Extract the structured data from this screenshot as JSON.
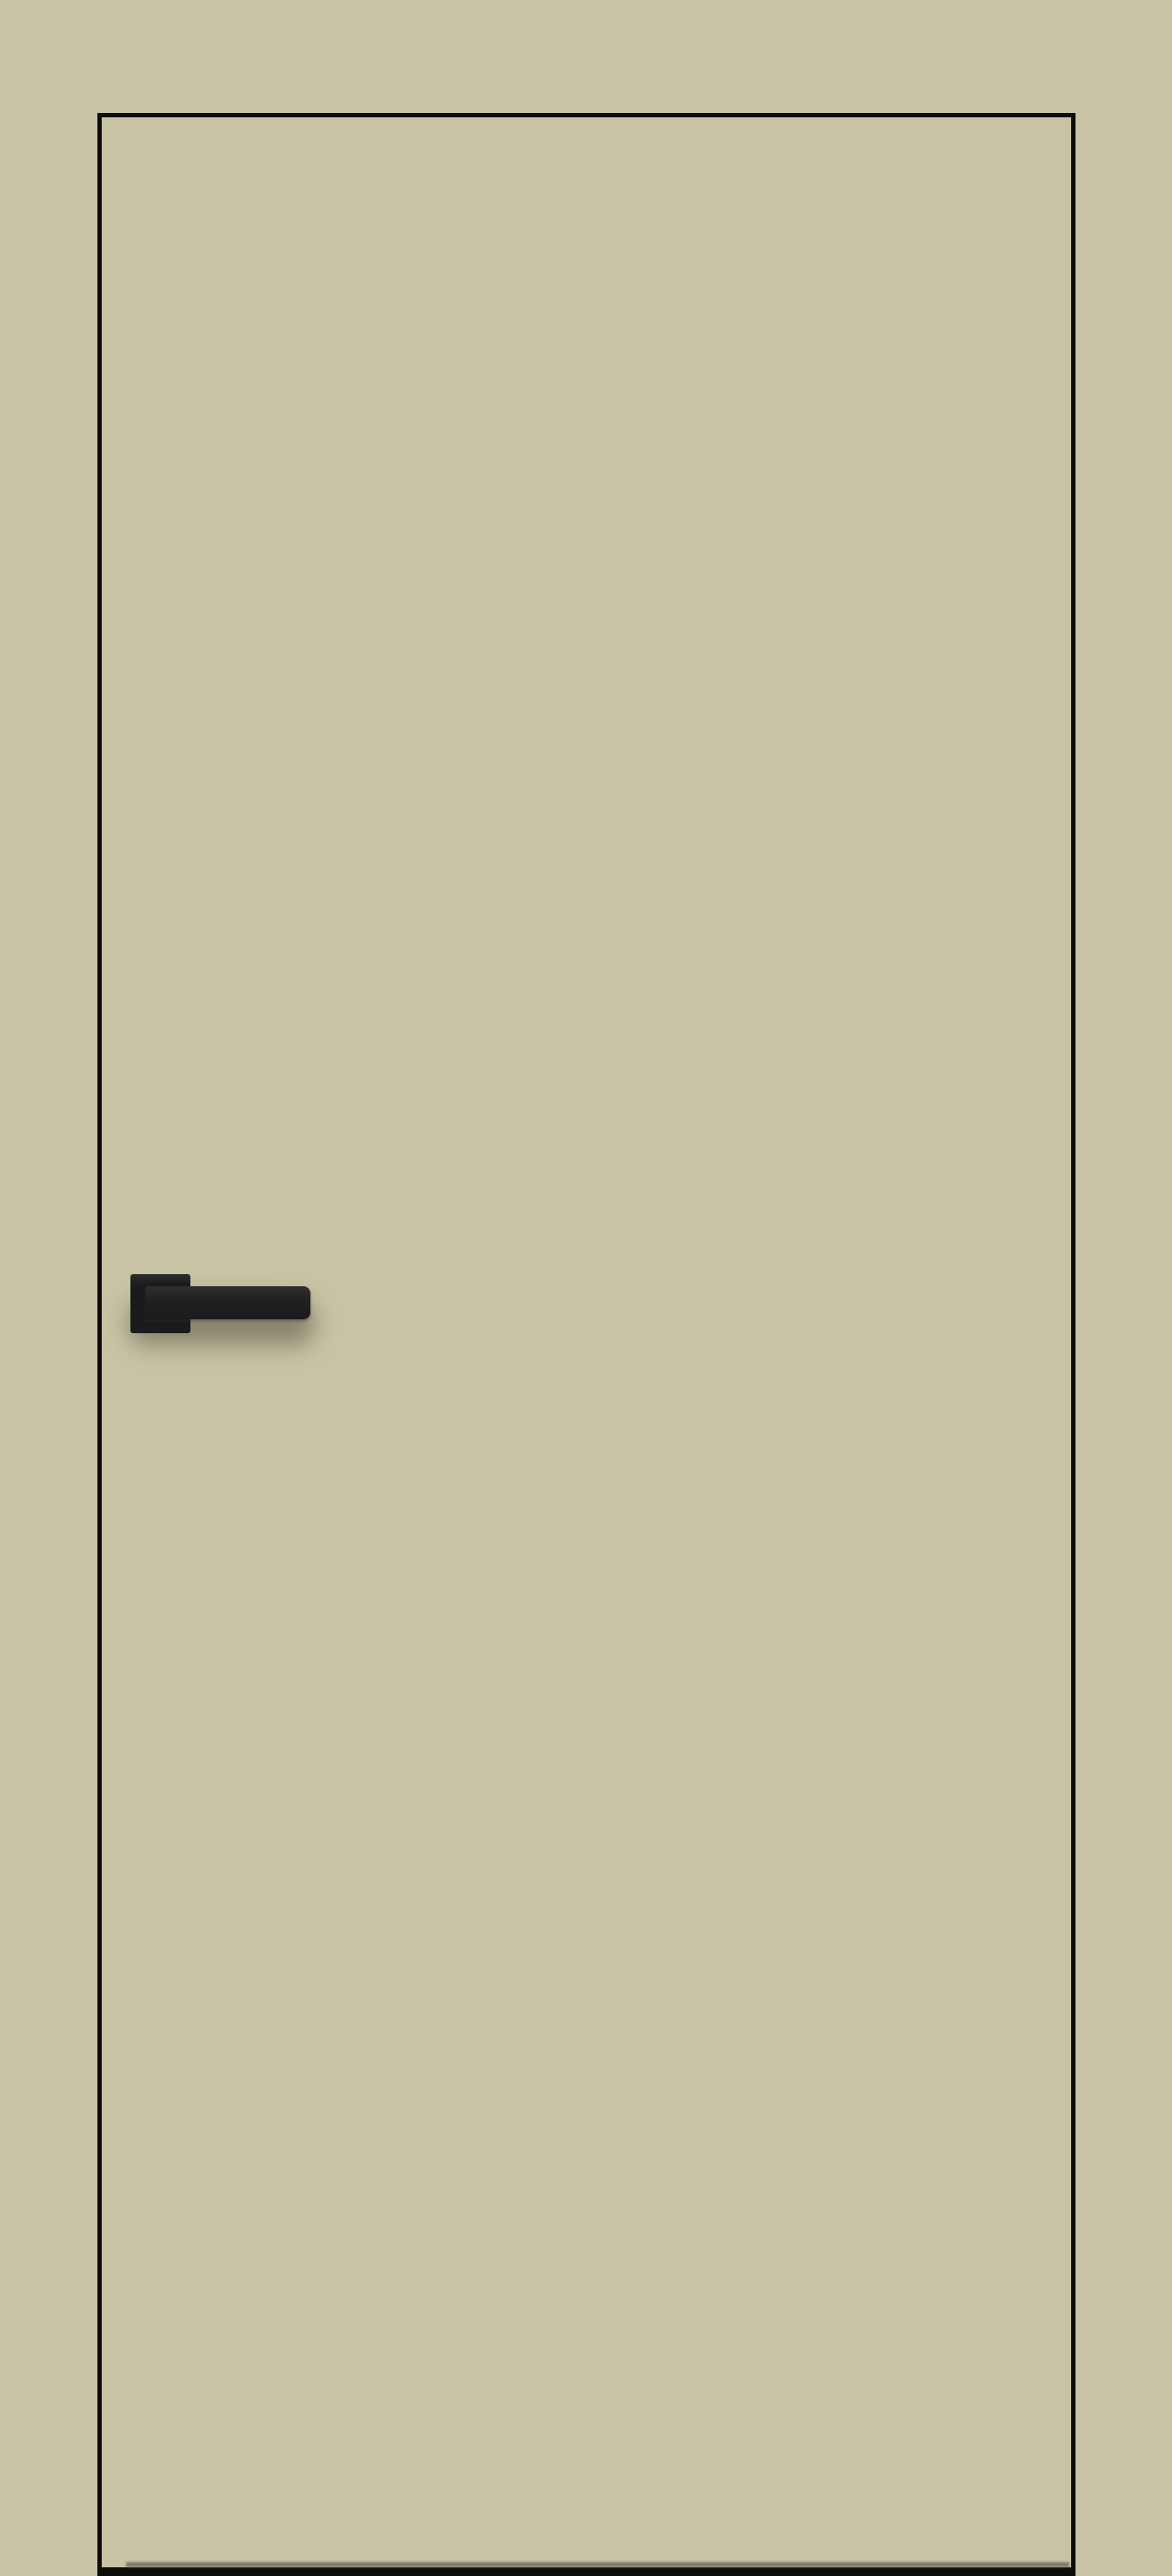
{
  "scene": {
    "type": "product-image",
    "description": "Flush frameless interior door leaf in a khaki/olive finish with thin black aluminium edge trim and a matte black lever handle on a square rosette, lever pointing right, mounted on the left side of the leaf",
    "door": {
      "face_color": "#c8c3a4",
      "edge_trim_color": "#0d0d0b",
      "bottom_shadow_line_color": "#6f6e64"
    },
    "handle": {
      "style": "square-rosette lever",
      "color": "#1b1b1d",
      "highlight_color": "#2e2e30",
      "orientation": "horizontal, pointing right"
    },
    "background_color": "#c9c4a6",
    "shadow_color": "rgba(75,72,55,0.5)"
  }
}
